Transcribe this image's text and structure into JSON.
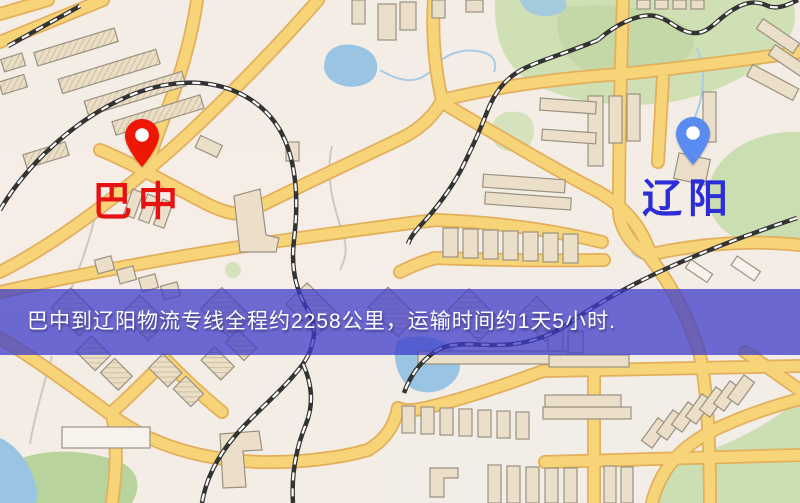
{
  "map": {
    "markers": [
      {
        "id": "origin",
        "label": "巴中",
        "pin_color": "#ee1605",
        "label_color": "#e61212"
      },
      {
        "id": "destination",
        "label": "辽阳",
        "pin_color": "#5a8bf0",
        "label_color": "#2b2ed6"
      }
    ],
    "features": {
      "road_color": "#f8d478",
      "railway_color": "#333333",
      "park_color": "#cfe0b5",
      "water_color": "#9ac4e4",
      "building_color": "#ebdfc9"
    }
  },
  "banner": {
    "text": "巴中到辽阳物流专线全程约2258公里，运输时间约1天5小时.",
    "bg_color": "rgba(62,60,202,0.75)",
    "text_color": "#ffffff"
  }
}
